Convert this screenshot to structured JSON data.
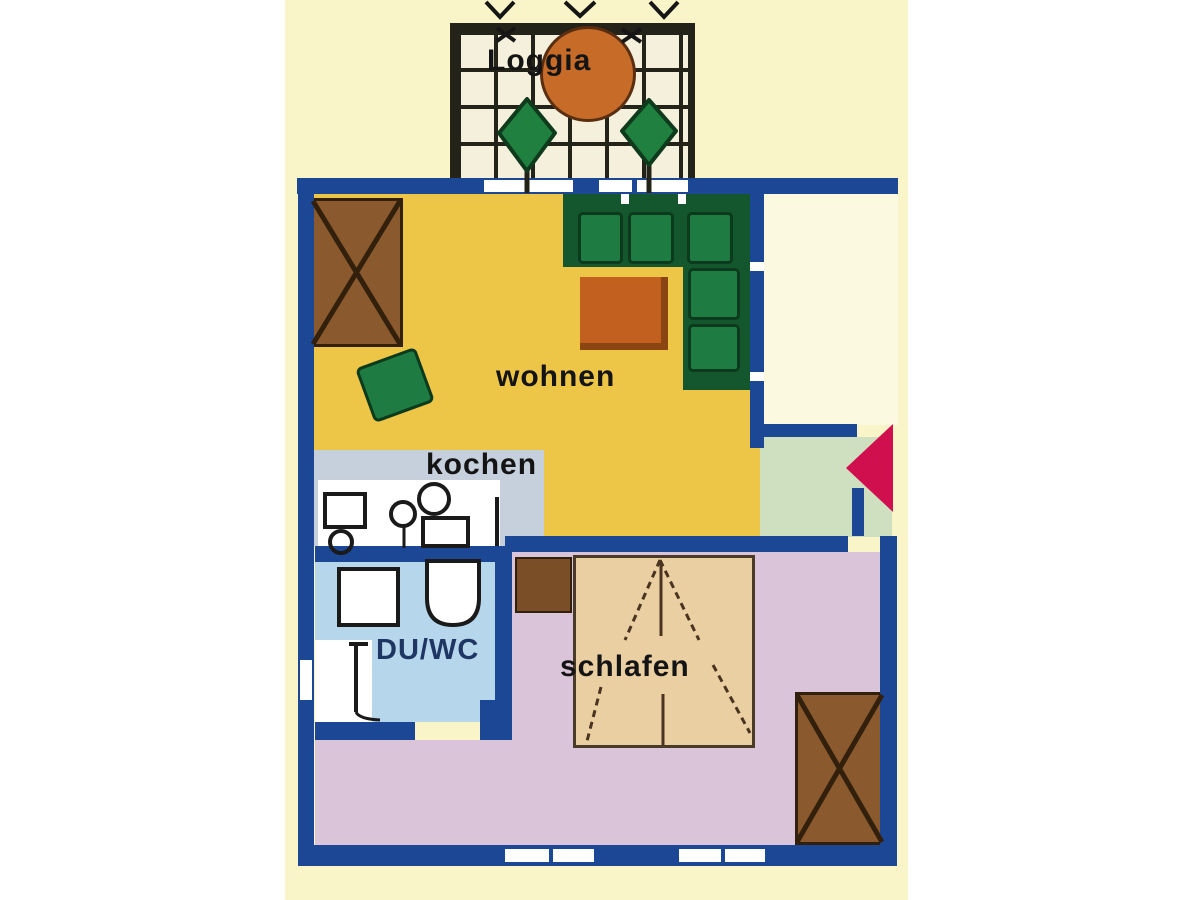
{
  "floorplan": {
    "rooms": {
      "loggia": {
        "label": "Loggia"
      },
      "living": {
        "label": "wohnen"
      },
      "kitchen": {
        "label": "kochen"
      },
      "bath": {
        "label": "DU/WC"
      },
      "bedroom": {
        "label": "schlafen"
      }
    },
    "entrance": {
      "arrow_direction": "left"
    },
    "furniture": {
      "loggia": [
        "patio-table",
        "plant",
        "plant"
      ],
      "living": [
        "wardrobe",
        "corner-sofa",
        "coffee-table",
        "armchair"
      ],
      "kitchen": [
        "counter",
        "sink",
        "stove"
      ],
      "bath": [
        "shower",
        "toilet",
        "door-swing"
      ],
      "bedroom": [
        "double-bed",
        "nightstand",
        "wardrobe"
      ]
    },
    "colors": {
      "bg": "#ffffff",
      "band": "#faf5c9",
      "outside": "#fcf9e1",
      "wall": "#1c4795",
      "window": "#ffffff",
      "loggia-tile": "#f5f0dc",
      "grid-line": "#23231a",
      "living": "#eec647",
      "kitchen": "#c6d0dd",
      "counter": "#ffffff",
      "bath": "#b6d6ec",
      "bedroom": "#d9c4da",
      "hall": "#cfe0c1",
      "sofa-dark": "#14572e",
      "sofa-cushion": "#1e7b41",
      "cushion-border": "#0c3a1c",
      "table": "#c2611f",
      "table-edge": "#8a4512",
      "wardrobe": "#8a5a2e",
      "wood-dark": "#7a4e26",
      "wood-line": "#32200c",
      "bed": "#eacfa2",
      "bed-line": "#4a3420",
      "tree": "#1f8040",
      "tree-outline": "#0f3a1c",
      "loggia-table": "#c76b29",
      "arrow": "#d0104e",
      "label": "#141414",
      "bath-label": "#1f3664",
      "outline": "#1a1a1a"
    }
  }
}
